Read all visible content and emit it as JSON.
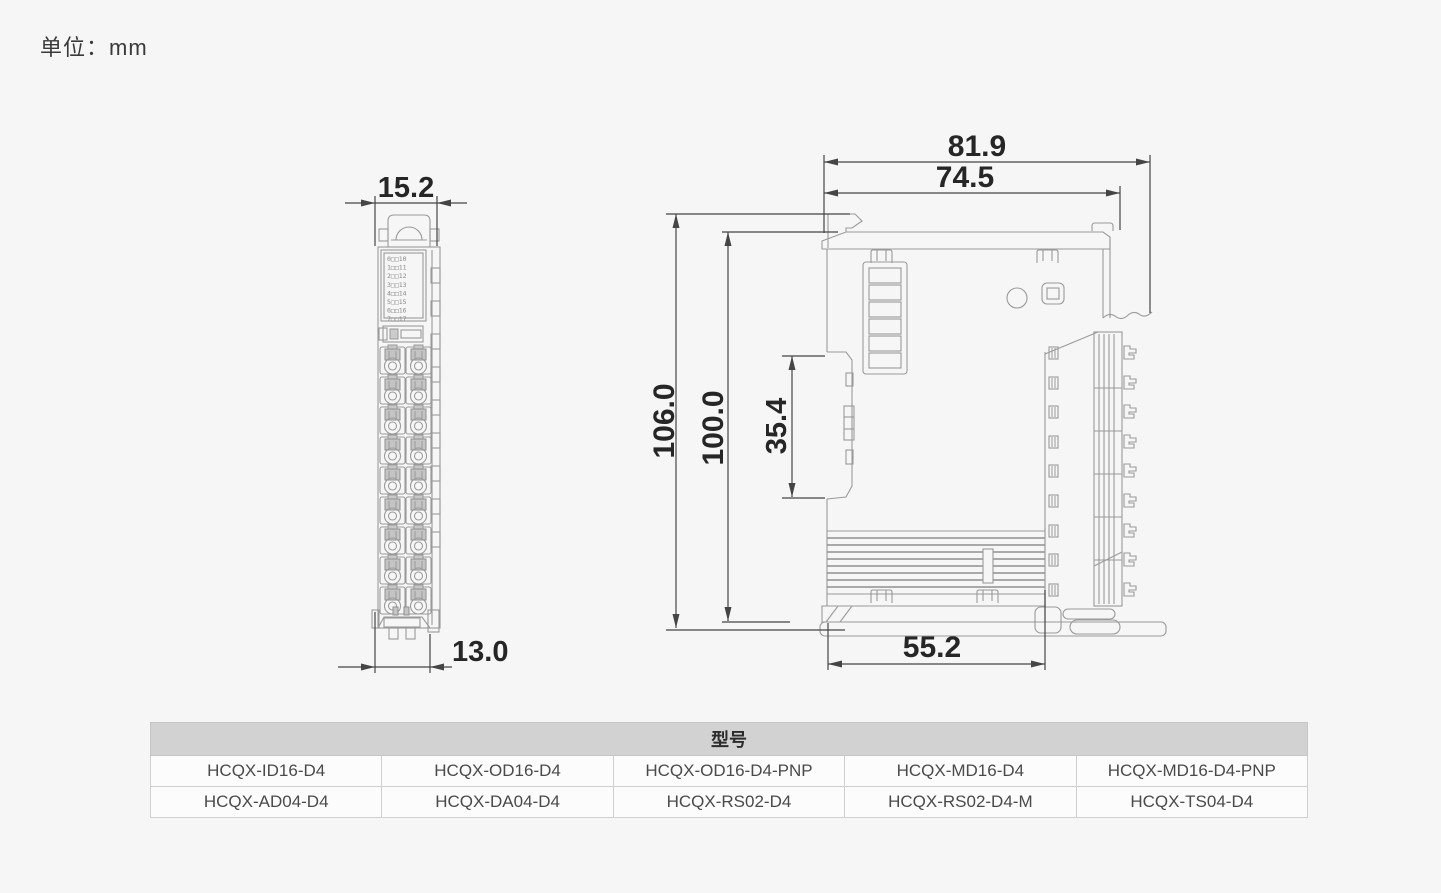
{
  "unit_label": "单位：mm",
  "front_view": {
    "dim_width_top": "15.2",
    "dim_width_bottom": "13.0",
    "led_labels": [
      "0□□10",
      "1□□11",
      "2□□12",
      "3□□13",
      "4□□14",
      "5□□15",
      "6□□16",
      "7□□17"
    ]
  },
  "side_view": {
    "dim_total_width": "81.9",
    "dim_body_width": "74.5",
    "dim_total_height": "106.0",
    "dim_body_height": "100.0",
    "dim_din_slot": "35.4",
    "dim_base_width": "55.2"
  },
  "model_table": {
    "header": "型号",
    "rows": [
      [
        "HCQX-ID16-D4",
        "HCQX-OD16-D4",
        "HCQX-OD16-D4-PNP",
        "HCQX-MD16-D4",
        "HCQX-MD16-D4-PNP"
      ],
      [
        "HCQX-AD04-D4",
        "HCQX-DA04-D4",
        "HCQX-RS02-D4",
        "HCQX-RS02-D4-M",
        "HCQX-TS04-D4"
      ]
    ]
  },
  "colors": {
    "background": "#f6f6f6",
    "drawing_line": "#9a9a9a",
    "dimension_line": "#454545",
    "dimension_text": "#262626",
    "table_header_bg": "#d2d2d2",
    "table_cell_bg": "#fcfcfc"
  }
}
